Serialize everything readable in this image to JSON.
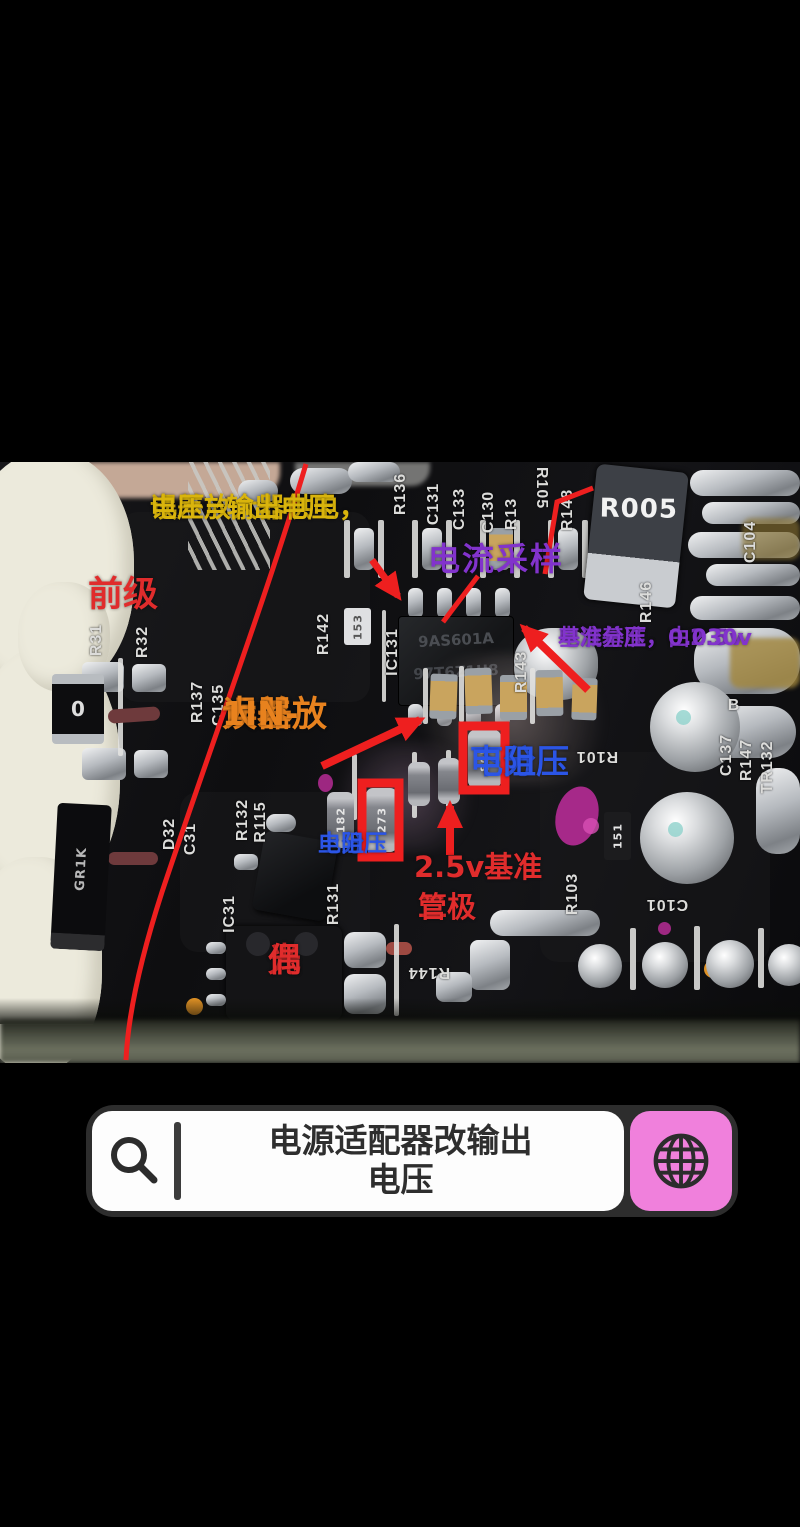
{
  "overlay": {
    "supply1": "误差放大器供电，",
    "supply2": "电压=输出电压",
    "front_stage": "前级",
    "current_sampling": "电流采样",
    "current_ref1": "电流基准，由2.5v",
    "current_ref2": "基准分压，0.030v",
    "error_amp1": "误差放",
    "error_amp2": "大器",
    "error_amp3": "1IN-",
    "lower_div1": "下分压",
    "lower_div2": "电阻",
    "upper_div1": "上分压",
    "upper_div2": "电阻",
    "vref": "2.5v基准",
    "diode1": "二极",
    "diode2": "管",
    "opto1": "光",
    "opto2": "偶"
  },
  "silkscreen": {
    "r136": "R136",
    "c131": "C131",
    "c133": "C133",
    "c130": "C130",
    "r13": "R13",
    "r105": "R105",
    "r148": "R148",
    "c104": "C104",
    "r31": "R31",
    "r32": "R32",
    "r137": "R137",
    "c135": "C135",
    "r142": "R142",
    "ic131": "IC131",
    "r143": "R143",
    "r146": "R146",
    "b": "B",
    "c137": "C137",
    "r147": "R147",
    "tr132": "TR132",
    "r101": "R101",
    "r132": "R132",
    "r115": "R115",
    "d32": "D32",
    "c31": "C31",
    "ic31": "IC31",
    "r131": "R131",
    "r103": "R103",
    "c101": "C101",
    "r144": "R144"
  },
  "markings": {
    "shunt": "R005",
    "chip1": "9AS601A",
    "chip2": "97T6Z1U8",
    "zero": "0",
    "diode": "GR1K",
    "res182": "182",
    "res273": "273",
    "res805": "805",
    "res153": "153",
    "res151": "151"
  },
  "search": {
    "line1": "电源适配器改输出",
    "line2": "电压"
  },
  "colors": {
    "annotation_yellow": "#d9b40c",
    "annotation_orange": "#e8821e",
    "annotation_red": "#e02c2c",
    "annotation_blue": "#2b55e6",
    "annotation_purple": "#8233cc",
    "marker_red": "#ee1f1f",
    "pink_button": "#f080dc",
    "bar_border": "#2d2d2d"
  }
}
